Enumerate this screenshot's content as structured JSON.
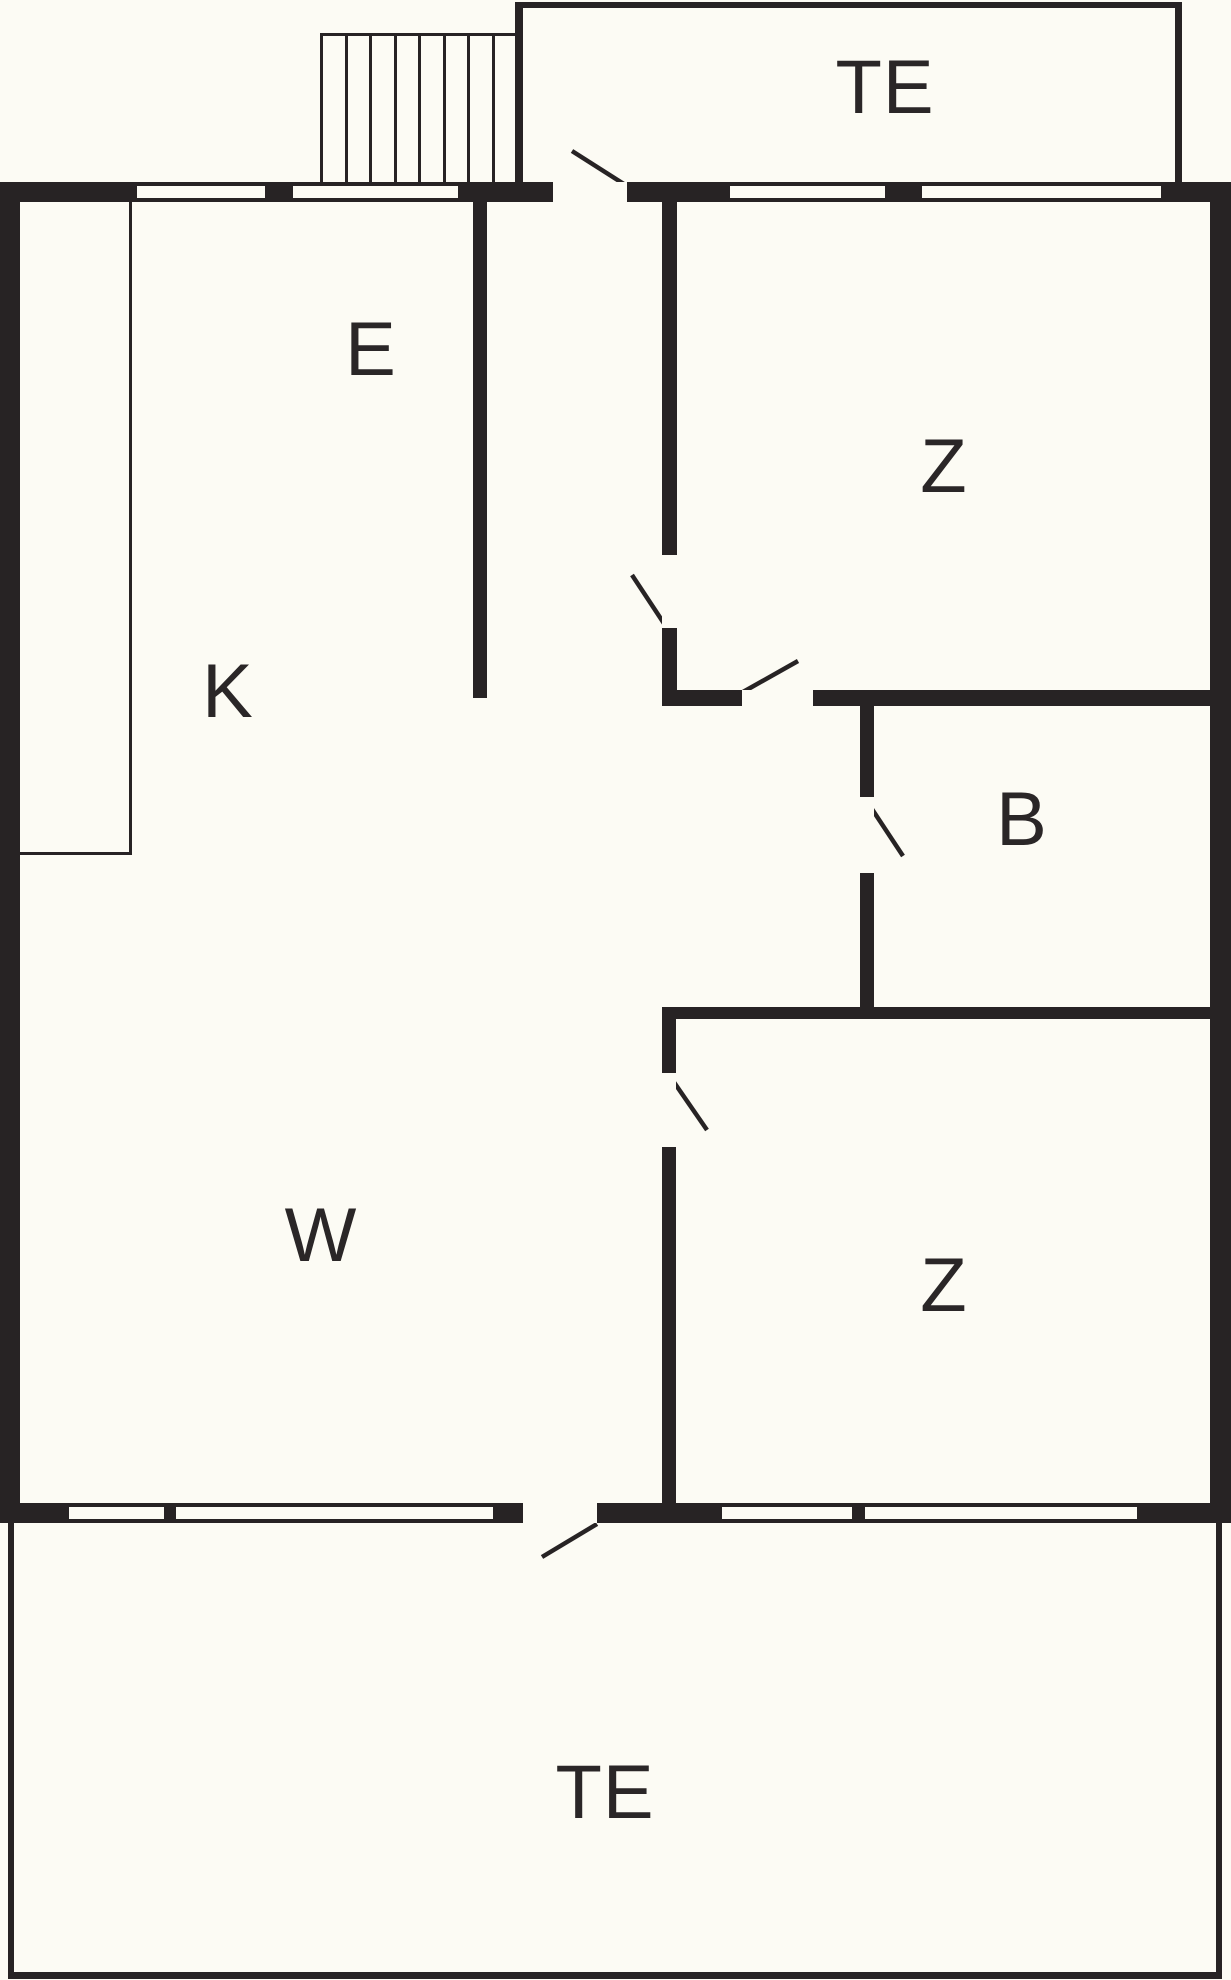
{
  "title": "Floor plan",
  "colors": {
    "background": "#fcfbf4",
    "wall": "#272324",
    "text": "#2a2627"
  },
  "canvas": {
    "width": 1231,
    "height": 1980
  },
  "rooms": [
    {
      "id": "te-top",
      "label": "TE",
      "cx": 885,
      "cy": 88
    },
    {
      "id": "e",
      "label": "E",
      "cx": 371,
      "cy": 350
    },
    {
      "id": "z-top",
      "label": "Z",
      "cx": 944,
      "cy": 467
    },
    {
      "id": "k",
      "label": "K",
      "cx": 228,
      "cy": 692
    },
    {
      "id": "b",
      "label": "B",
      "cx": 1022,
      "cy": 820
    },
    {
      "id": "w",
      "label": "W",
      "cx": 321,
      "cy": 1236
    },
    {
      "id": "z-bottom",
      "label": "Z",
      "cx": 944,
      "cy": 1286
    },
    {
      "id": "te-bottom",
      "label": "TE",
      "cx": 605,
      "cy": 1793
    }
  ],
  "plan": {
    "walls": [
      {
        "name": "outer-wall-top",
        "x": 0,
        "y": 182,
        "w": 1231,
        "h": 20
      },
      {
        "name": "outer-wall-left",
        "x": 0,
        "y": 182,
        "w": 20,
        "h": 1341
      },
      {
        "name": "outer-wall-right",
        "x": 1210,
        "y": 182,
        "w": 21,
        "h": 1341
      },
      {
        "name": "outer-wall-bottom",
        "x": 0,
        "y": 1503,
        "w": 1231,
        "h": 20
      },
      {
        "name": "wall-e-hall",
        "x": 473,
        "y": 202,
        "w": 14,
        "h": 496
      },
      {
        "name": "wall-hall-z-top",
        "x": 662,
        "y": 202,
        "w": 15,
        "h": 504
      },
      {
        "name": "wall-z-top-bottom",
        "x": 662,
        "y": 690,
        "w": 548,
        "h": 16
      },
      {
        "name": "wall-b-west",
        "x": 860,
        "y": 703,
        "w": 14,
        "h": 304
      },
      {
        "name": "wall-hall-z-bottom",
        "x": 662,
        "y": 1007,
        "w": 548,
        "h": 12
      },
      {
        "name": "wall-w-z-bottom",
        "x": 662,
        "y": 1007,
        "w": 14,
        "h": 516
      },
      {
        "name": "terrace-top-wall-left",
        "x": 515,
        "y": 2,
        "w": 8,
        "h": 180
      },
      {
        "name": "terrace-top-wall-top",
        "x": 515,
        "y": 2,
        "w": 667,
        "h": 6
      },
      {
        "name": "terrace-top-wall-right",
        "x": 1175,
        "y": 2,
        "w": 7,
        "h": 180
      },
      {
        "name": "terrace-bottom-wall-left",
        "x": 8,
        "y": 1523,
        "w": 6,
        "h": 456
      },
      {
        "name": "terrace-bottom-wall-right",
        "x": 1216,
        "y": 1523,
        "w": 6,
        "h": 456
      },
      {
        "name": "terrace-bottom-wall-bottom",
        "x": 8,
        "y": 1972,
        "w": 1214,
        "h": 7
      },
      {
        "name": "counter-line-vertical",
        "x": 129,
        "y": 202,
        "w": 3,
        "h": 653
      },
      {
        "name": "counter-line-horizontal",
        "x": 20,
        "y": 852,
        "w": 112,
        "h": 3
      },
      {
        "name": "stairs-top-line",
        "x": 320,
        "y": 33,
        "w": 196,
        "h": 3
      }
    ],
    "openings": [
      {
        "name": "door-opening-entrance-top",
        "x": 553,
        "y": 182,
        "w": 74,
        "h": 20
      },
      {
        "name": "door-opening-hall-z-top",
        "x": 662,
        "y": 555,
        "w": 15,
        "h": 73
      },
      {
        "name": "door-opening-z-top-closet",
        "x": 742,
        "y": 690,
        "w": 71,
        "h": 16
      },
      {
        "name": "door-opening-bathroom",
        "x": 860,
        "y": 797,
        "w": 14,
        "h": 76
      },
      {
        "name": "door-opening-w-z-bottom",
        "x": 662,
        "y": 1073,
        "w": 14,
        "h": 74
      },
      {
        "name": "door-opening-terrace",
        "x": 523,
        "y": 1503,
        "w": 74,
        "h": 20
      }
    ],
    "windows": [
      {
        "name": "window-top-1",
        "x": 137,
        "y": 182,
        "w": 128,
        "h": 20
      },
      {
        "name": "window-top-2",
        "x": 293,
        "y": 182,
        "w": 165,
        "h": 20
      },
      {
        "name": "window-top-3",
        "x": 730,
        "y": 182,
        "w": 155,
        "h": 20
      },
      {
        "name": "window-top-4",
        "x": 922,
        "y": 182,
        "w": 239,
        "h": 20
      },
      {
        "name": "window-bottom-1",
        "x": 69,
        "y": 1503,
        "w": 95,
        "h": 20
      },
      {
        "name": "window-bottom-2",
        "x": 176,
        "y": 1503,
        "w": 317,
        "h": 20
      },
      {
        "name": "window-bottom-3",
        "x": 722,
        "y": 1503,
        "w": 130,
        "h": 20
      },
      {
        "name": "window-bottom-4",
        "x": 865,
        "y": 1503,
        "w": 272,
        "h": 20
      }
    ],
    "stairs": {
      "x": 320,
      "y": 33,
      "width": 196,
      "height": 149,
      "steps": 8,
      "line_width": 3
    },
    "doors": [
      {
        "name": "door-swing-entrance-top",
        "x1": 627,
        "y1": 186,
        "x2": 572,
        "y2": 151
      },
      {
        "name": "door-swing-hall-z-top",
        "x1": 667,
        "y1": 628,
        "x2": 632,
        "y2": 575
      },
      {
        "name": "door-swing-z-top-closet",
        "x1": 743,
        "y1": 692,
        "x2": 798,
        "y2": 661
      },
      {
        "name": "door-swing-bathroom",
        "x1": 866,
        "y1": 800,
        "x2": 903,
        "y2": 856
      },
      {
        "name": "door-swing-w-z-bottom",
        "x1": 669,
        "y1": 1075,
        "x2": 707,
        "y2": 1130
      },
      {
        "name": "door-swing-terrace",
        "x1": 597,
        "y1": 1524,
        "x2": 542,
        "y2": 1557
      }
    ]
  }
}
